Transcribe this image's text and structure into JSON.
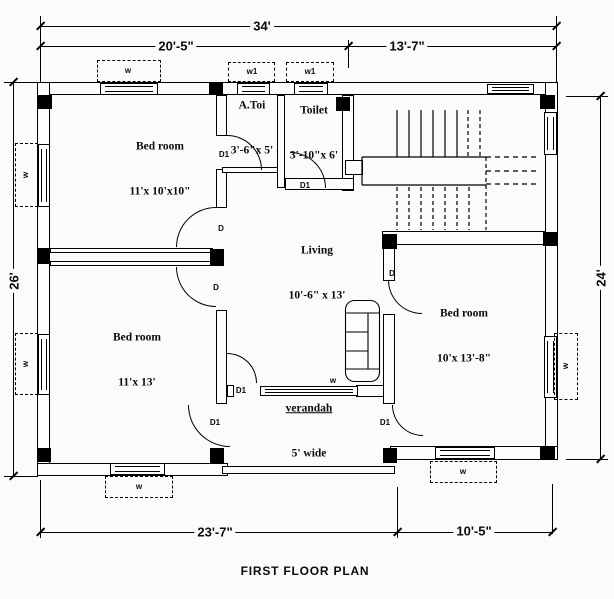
{
  "title": "FIRST FLOOR PLAN",
  "dimensions": {
    "top_total": "34'",
    "top_left_span": "20'-5\"",
    "top_right_span": "13'-7\"",
    "left_side": "26'",
    "right_side": "24'",
    "bottom_left_span": "23'-7\"",
    "bottom_right_span": "10'-5\""
  },
  "rooms": [
    {
      "name": "Bed room",
      "size": "11'x 10'x10\""
    },
    {
      "name": "A.Toi",
      "size": "3'-6\"x 5'"
    },
    {
      "name": "Toilet",
      "size": "3'-10\"x 6'"
    },
    {
      "name": "Living",
      "size": "10'-6\" x 13'"
    },
    {
      "name": "Bed room",
      "size": "11'x 13'"
    },
    {
      "name": "Bed room",
      "size": "10'x 13'-8\""
    },
    {
      "name": "verandah",
      "size": "5' wide"
    }
  ],
  "doors": [
    {
      "label": "D1"
    },
    {
      "label": "D1"
    },
    {
      "label": "D"
    },
    {
      "label": "D"
    },
    {
      "label": "D"
    },
    {
      "label": "D1"
    },
    {
      "label": "D1"
    },
    {
      "label": "D1"
    }
  ],
  "windows": [
    {
      "label": "w"
    },
    {
      "label": "w1"
    },
    {
      "label": "w1"
    },
    {
      "label": "w"
    },
    {
      "label": "w"
    },
    {
      "label": "w"
    },
    {
      "label": "w"
    },
    {
      "label": "w"
    },
    {
      "label": "w"
    }
  ]
}
